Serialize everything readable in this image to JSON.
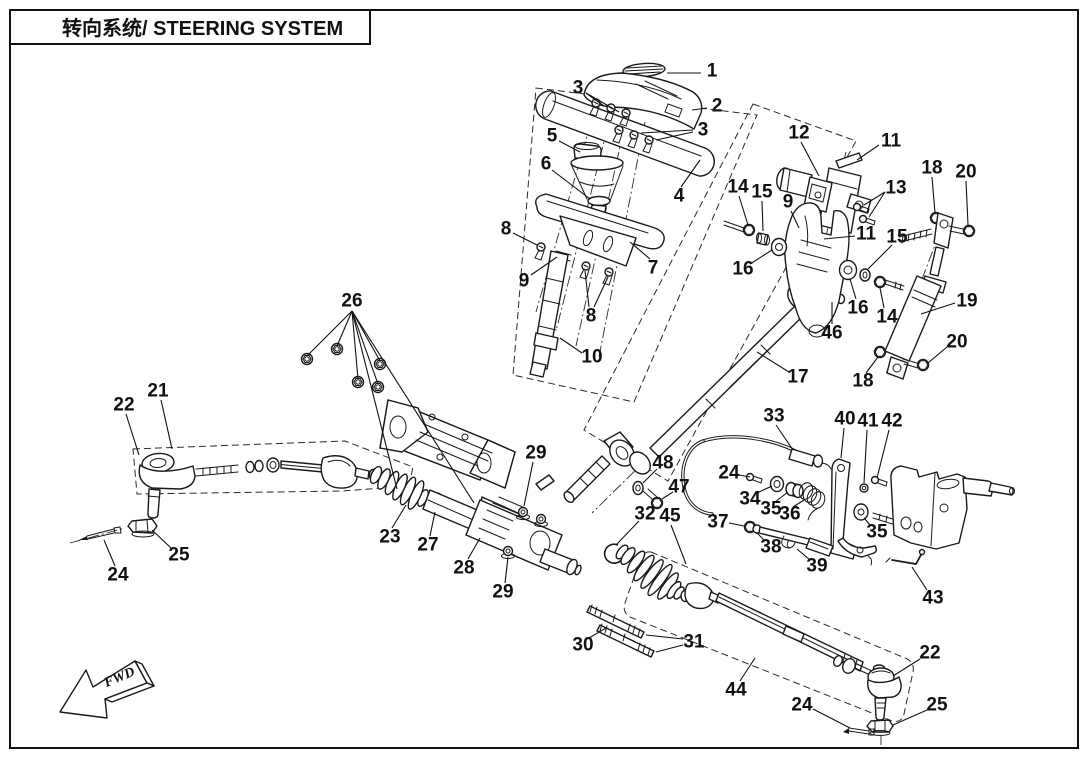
{
  "title": {
    "text": "转向系统/ STEERING SYSTEM"
  },
  "direction_marker": {
    "label": "FWD"
  },
  "line_color": "#1a1a1a",
  "background_color": "#ffffff",
  "callouts": [
    {
      "n": "1",
      "x": 712,
      "y": 71,
      "leaders": [
        [
          701,
          73,
          667,
          73
        ]
      ]
    },
    {
      "n": "2",
      "x": 717,
      "y": 106,
      "leaders": [
        [
          707,
          108,
          692,
          110
        ]
      ]
    },
    {
      "n": "3",
      "x": 578,
      "y": 88,
      "leaders": [
        [
          586,
          93,
          604,
          106
        ],
        [
          586,
          93,
          619,
          112
        ]
      ]
    },
    {
      "n": "3",
      "x": 703,
      "y": 130,
      "leaders": [
        [
          693,
          132,
          656,
          140
        ],
        [
          693,
          130,
          641,
          133
        ]
      ]
    },
    {
      "n": "4",
      "x": 679,
      "y": 196,
      "leaders": [
        [
          681,
          187,
          700,
          160
        ]
      ]
    },
    {
      "n": "5",
      "x": 552,
      "y": 136,
      "leaders": [
        [
          559,
          141,
          580,
          152
        ]
      ]
    },
    {
      "n": "6",
      "x": 546,
      "y": 164,
      "leaders": [
        [
          552,
          170,
          590,
          199
        ]
      ]
    },
    {
      "n": "7",
      "x": 653,
      "y": 268,
      "leaders": [
        [
          650,
          259,
          630,
          242
        ]
      ]
    },
    {
      "n": "8",
      "x": 506,
      "y": 229,
      "leaders": [
        [
          513,
          233,
          537,
          245
        ]
      ]
    },
    {
      "n": "9",
      "x": 524,
      "y": 281,
      "leaders": [
        [
          531,
          275,
          557,
          257
        ]
      ]
    },
    {
      "n": "8",
      "x": 591,
      "y": 316,
      "leaders": [
        [
          589,
          307,
          585,
          271
        ],
        [
          594,
          307,
          608,
          277
        ]
      ]
    },
    {
      "n": "10",
      "x": 592,
      "y": 357,
      "leaders": [
        [
          582,
          353,
          560,
          338
        ]
      ]
    },
    {
      "n": "11",
      "x": 891,
      "y": 141,
      "leaders": [
        [
          879,
          145,
          857,
          160
        ]
      ]
    },
    {
      "n": "12",
      "x": 799,
      "y": 133,
      "leaders": [
        [
          801,
          142,
          819,
          176
        ]
      ]
    },
    {
      "n": "13",
      "x": 896,
      "y": 188,
      "leaders": [
        [
          885,
          192,
          864,
          205
        ],
        [
          885,
          192,
          869,
          217
        ]
      ]
    },
    {
      "n": "14",
      "x": 738,
      "y": 187,
      "leaders": [
        [
          739,
          196,
          748,
          225
        ]
      ]
    },
    {
      "n": "15",
      "x": 762,
      "y": 192,
      "leaders": [
        [
          762,
          201,
          763,
          231
        ]
      ]
    },
    {
      "n": "9",
      "x": 788,
      "y": 202,
      "leaders": [
        [
          791,
          211,
          799,
          228
        ]
      ]
    },
    {
      "n": "16",
      "x": 743,
      "y": 269,
      "leaders": [
        [
          750,
          264,
          772,
          250
        ]
      ]
    },
    {
      "n": "11",
      "x": 866,
      "y": 234,
      "leaders": [
        [
          855,
          236,
          824,
          239
        ]
      ]
    },
    {
      "n": "15",
      "x": 897,
      "y": 237,
      "leaders": [
        [
          892,
          245,
          868,
          269
        ]
      ]
    },
    {
      "n": "16",
      "x": 858,
      "y": 308,
      "leaders": [
        [
          856,
          299,
          850,
          279
        ]
      ]
    },
    {
      "n": "14",
      "x": 887,
      "y": 317,
      "leaders": [
        [
          884,
          308,
          880,
          288
        ]
      ]
    },
    {
      "n": "18",
      "x": 932,
      "y": 168,
      "leaders": [
        [
          932,
          177,
          935,
          213
        ]
      ]
    },
    {
      "n": "20",
      "x": 966,
      "y": 172,
      "leaders": [
        [
          966,
          181,
          968,
          225
        ]
      ]
    },
    {
      "n": "19",
      "x": 967,
      "y": 301,
      "leaders": [
        [
          955,
          303,
          921,
          314
        ]
      ]
    },
    {
      "n": "20",
      "x": 957,
      "y": 342,
      "leaders": [
        [
          947,
          347,
          928,
          363
        ]
      ]
    },
    {
      "n": "18",
      "x": 863,
      "y": 381,
      "leaders": [
        [
          866,
          373,
          878,
          357
        ]
      ]
    },
    {
      "n": "46",
      "x": 832,
      "y": 333,
      "leaders": [
        [
          832,
          324,
          832,
          302
        ]
      ]
    },
    {
      "n": "17",
      "x": 798,
      "y": 377,
      "leaders": [
        [
          789,
          372,
          757,
          352
        ]
      ]
    },
    {
      "n": "21",
      "x": 158,
      "y": 391,
      "leaders": [
        [
          161,
          400,
          172,
          449
        ]
      ]
    },
    {
      "n": "22",
      "x": 124,
      "y": 405,
      "leaders": [
        [
          126,
          414,
          139,
          455
        ]
      ]
    },
    {
      "n": "25",
      "x": 179,
      "y": 555,
      "leaders": [
        [
          172,
          549,
          152,
          530
        ]
      ]
    },
    {
      "n": "24",
      "x": 118,
      "y": 575,
      "leaders": [
        [
          115,
          566,
          104,
          540
        ]
      ]
    },
    {
      "n": "23",
      "x": 390,
      "y": 537,
      "leaders": [
        [
          392,
          528,
          406,
          505
        ]
      ]
    },
    {
      "n": "27",
      "x": 428,
      "y": 545,
      "leaders": [
        [
          430,
          536,
          435,
          512
        ]
      ]
    },
    {
      "n": "28",
      "x": 464,
      "y": 568,
      "leaders": [
        [
          468,
          559,
          480,
          538
        ]
      ]
    },
    {
      "n": "29",
      "x": 503,
      "y": 592,
      "leaders": [
        [
          505,
          583,
          508,
          557
        ]
      ]
    },
    {
      "n": "29",
      "x": 536,
      "y": 453,
      "leaders": [
        [
          533,
          462,
          524,
          506
        ]
      ]
    },
    {
      "n": "26",
      "x": 352,
      "y": 301,
      "leaders": [
        [
          352,
          311,
          307,
          356
        ],
        [
          352,
          311,
          337,
          346
        ],
        [
          352,
          311,
          358,
          379
        ],
        [
          352,
          311,
          378,
          384
        ],
        [
          352,
          311,
          380,
          361
        ],
        [
          352,
          311,
          397,
          489
        ],
        [
          352,
          311,
          474,
          503
        ]
      ]
    },
    {
      "n": "30",
      "x": 583,
      "y": 645,
      "leaders": [
        [
          589,
          638,
          606,
          628
        ]
      ]
    },
    {
      "n": "31",
      "x": 694,
      "y": 642,
      "leaders": [
        [
          683,
          639,
          646,
          635
        ],
        [
          683,
          645,
          656,
          652
        ]
      ]
    },
    {
      "n": "44",
      "x": 736,
      "y": 690,
      "leaders": [
        [
          740,
          681,
          755,
          658
        ]
      ]
    },
    {
      "n": "22",
      "x": 930,
      "y": 653,
      "leaders": [
        [
          920,
          659,
          893,
          676
        ]
      ]
    },
    {
      "n": "24",
      "x": 802,
      "y": 705,
      "leaders": [
        [
          813,
          709,
          850,
          728
        ]
      ]
    },
    {
      "n": "25",
      "x": 937,
      "y": 705,
      "leaders": [
        [
          927,
          710,
          893,
          725
        ]
      ]
    },
    {
      "n": "45",
      "x": 670,
      "y": 516,
      "leaders": [
        [
          671,
          525,
          686,
          564
        ]
      ]
    },
    {
      "n": "32",
      "x": 645,
      "y": 514,
      "leaders": [
        [
          639,
          521,
          616,
          545
        ]
      ]
    },
    {
      "n": "47",
      "x": 679,
      "y": 487,
      "leaders": [
        [
          673,
          492,
          662,
          499
        ]
      ]
    },
    {
      "n": "48",
      "x": 663,
      "y": 463,
      "leaders": [
        [
          657,
          469,
          643,
          483
        ]
      ]
    },
    {
      "n": "33",
      "x": 774,
      "y": 416,
      "leaders": [
        [
          776,
          425,
          793,
          450
        ]
      ]
    },
    {
      "n": "40",
      "x": 845,
      "y": 419,
      "leaders": [
        [
          844,
          428,
          841,
          458
        ]
      ]
    },
    {
      "n": "41",
      "x": 868,
      "y": 421,
      "leaders": [
        [
          867,
          430,
          864,
          483
        ]
      ]
    },
    {
      "n": "42",
      "x": 892,
      "y": 421,
      "leaders": [
        [
          889,
          430,
          877,
          478
        ]
      ]
    },
    {
      "n": "24",
      "x": 729,
      "y": 473,
      "leaders": [
        [
          739,
          475,
          750,
          477
        ]
      ]
    },
    {
      "n": "34",
      "x": 750,
      "y": 499,
      "leaders": [
        [
          757,
          493,
          772,
          486
        ]
      ]
    },
    {
      "n": "35",
      "x": 771,
      "y": 509,
      "leaders": [
        [
          775,
          502,
          788,
          492
        ]
      ]
    },
    {
      "n": "36",
      "x": 790,
      "y": 514,
      "leaders": [
        [
          793,
          507,
          804,
          500
        ]
      ]
    },
    {
      "n": "37",
      "x": 718,
      "y": 522,
      "leaders": [
        [
          729,
          523,
          744,
          526
        ]
      ]
    },
    {
      "n": "38",
      "x": 771,
      "y": 547,
      "leaders": [
        [
          765,
          541,
          757,
          533
        ]
      ]
    },
    {
      "n": "39",
      "x": 817,
      "y": 566,
      "leaders": [
        [
          810,
          560,
          797,
          549
        ]
      ]
    },
    {
      "n": "35",
      "x": 877,
      "y": 532,
      "leaders": [
        [
          871,
          526,
          864,
          518
        ]
      ]
    },
    {
      "n": "43",
      "x": 933,
      "y": 598,
      "leaders": [
        [
          927,
          590,
          912,
          567
        ]
      ]
    }
  ]
}
